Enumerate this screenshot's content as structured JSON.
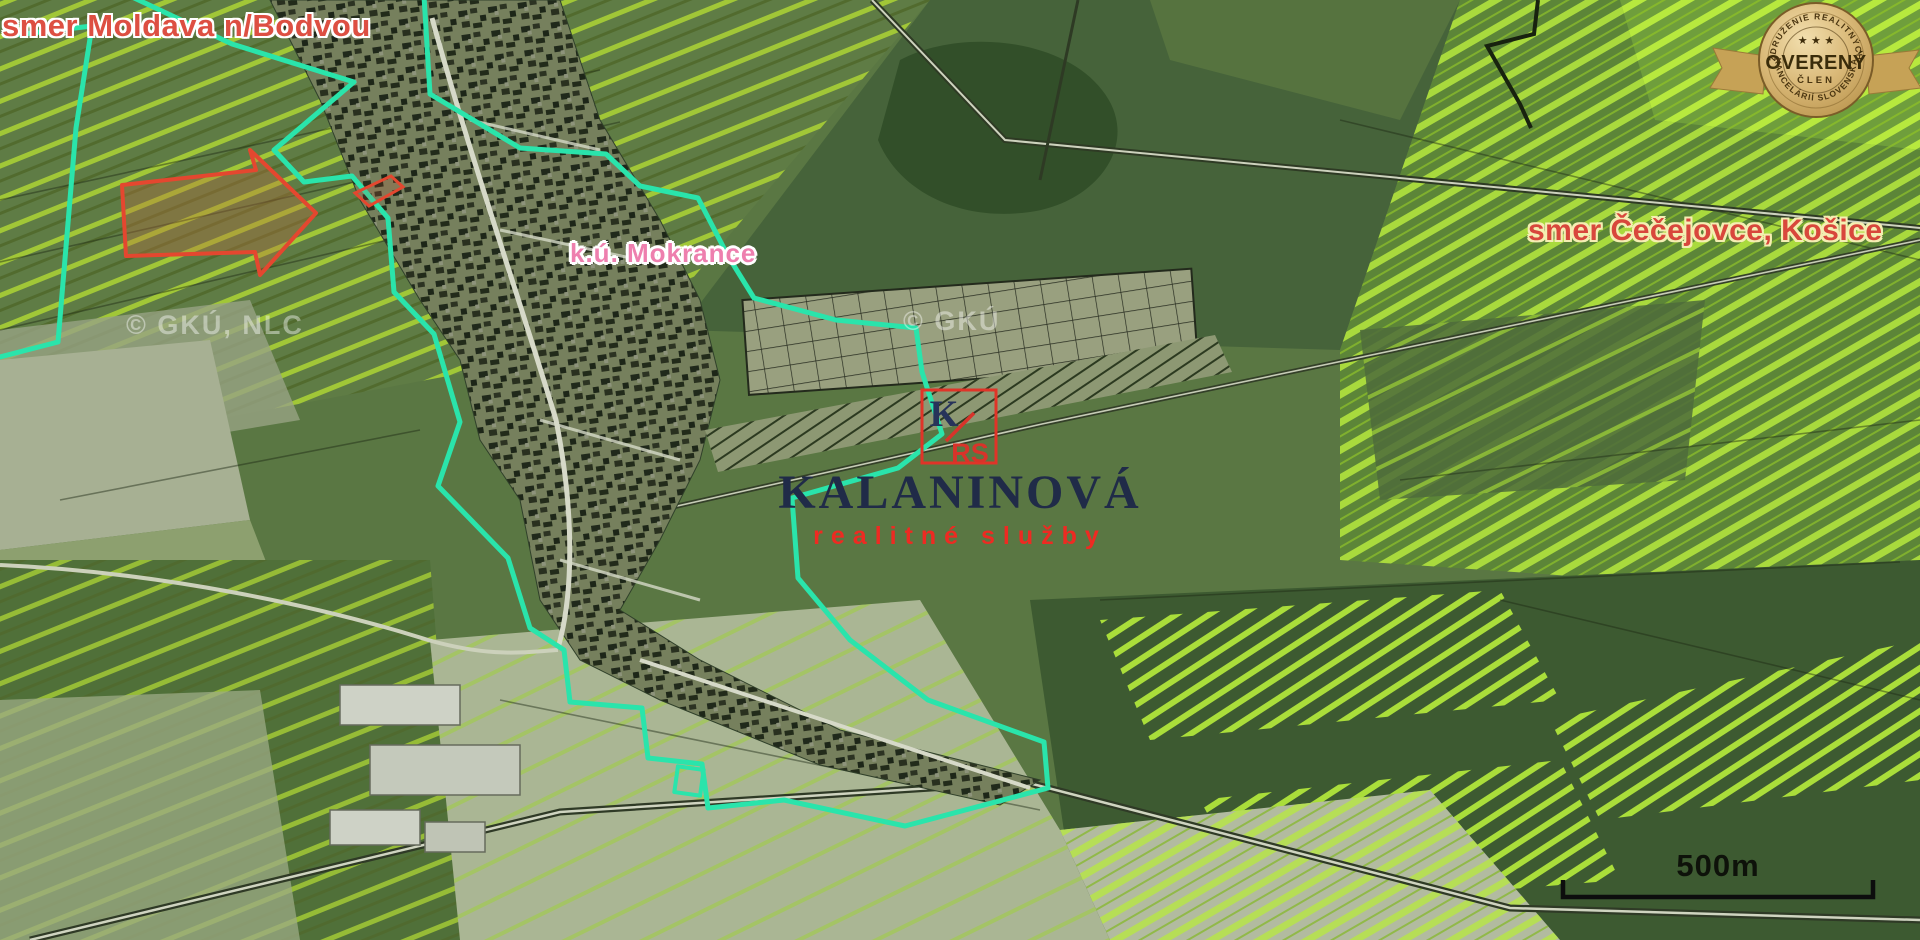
{
  "map": {
    "labels": {
      "direction_left": "smer Moldava n/Bodvou",
      "direction_right": "smer Čečejovce, Košice",
      "cadastral_area": "k.ú. Mokrance",
      "watermark_left": "© GKÚ, NLC",
      "watermark_center": "© GKÚ",
      "scale": "500m"
    },
    "marker": {
      "letter_k": "K",
      "letters_rs": "RS"
    },
    "colors": {
      "boundary_teal": "#2ae4ab",
      "marker_red": "#e03428",
      "direction_label_red": "#dd4f42",
      "cadastral_label_pink": "#ee7fae",
      "brand_navy": "#202b48",
      "brand_red": "#ee2a22",
      "badge_gold": "#d9b877",
      "field_stripe_green": "#a8cf35"
    }
  },
  "brand": {
    "name": "KALANINOVÁ",
    "tagline": "realitné služby"
  },
  "badge": {
    "arc_top": "ZDRUŽENIE REALITNÝCH",
    "stars": "★ ★ ★",
    "title": "OVERENÝ",
    "subtitle": "ČLEN",
    "arc_bottom": "KANCELÁRIÍ SLOVENSKA"
  }
}
